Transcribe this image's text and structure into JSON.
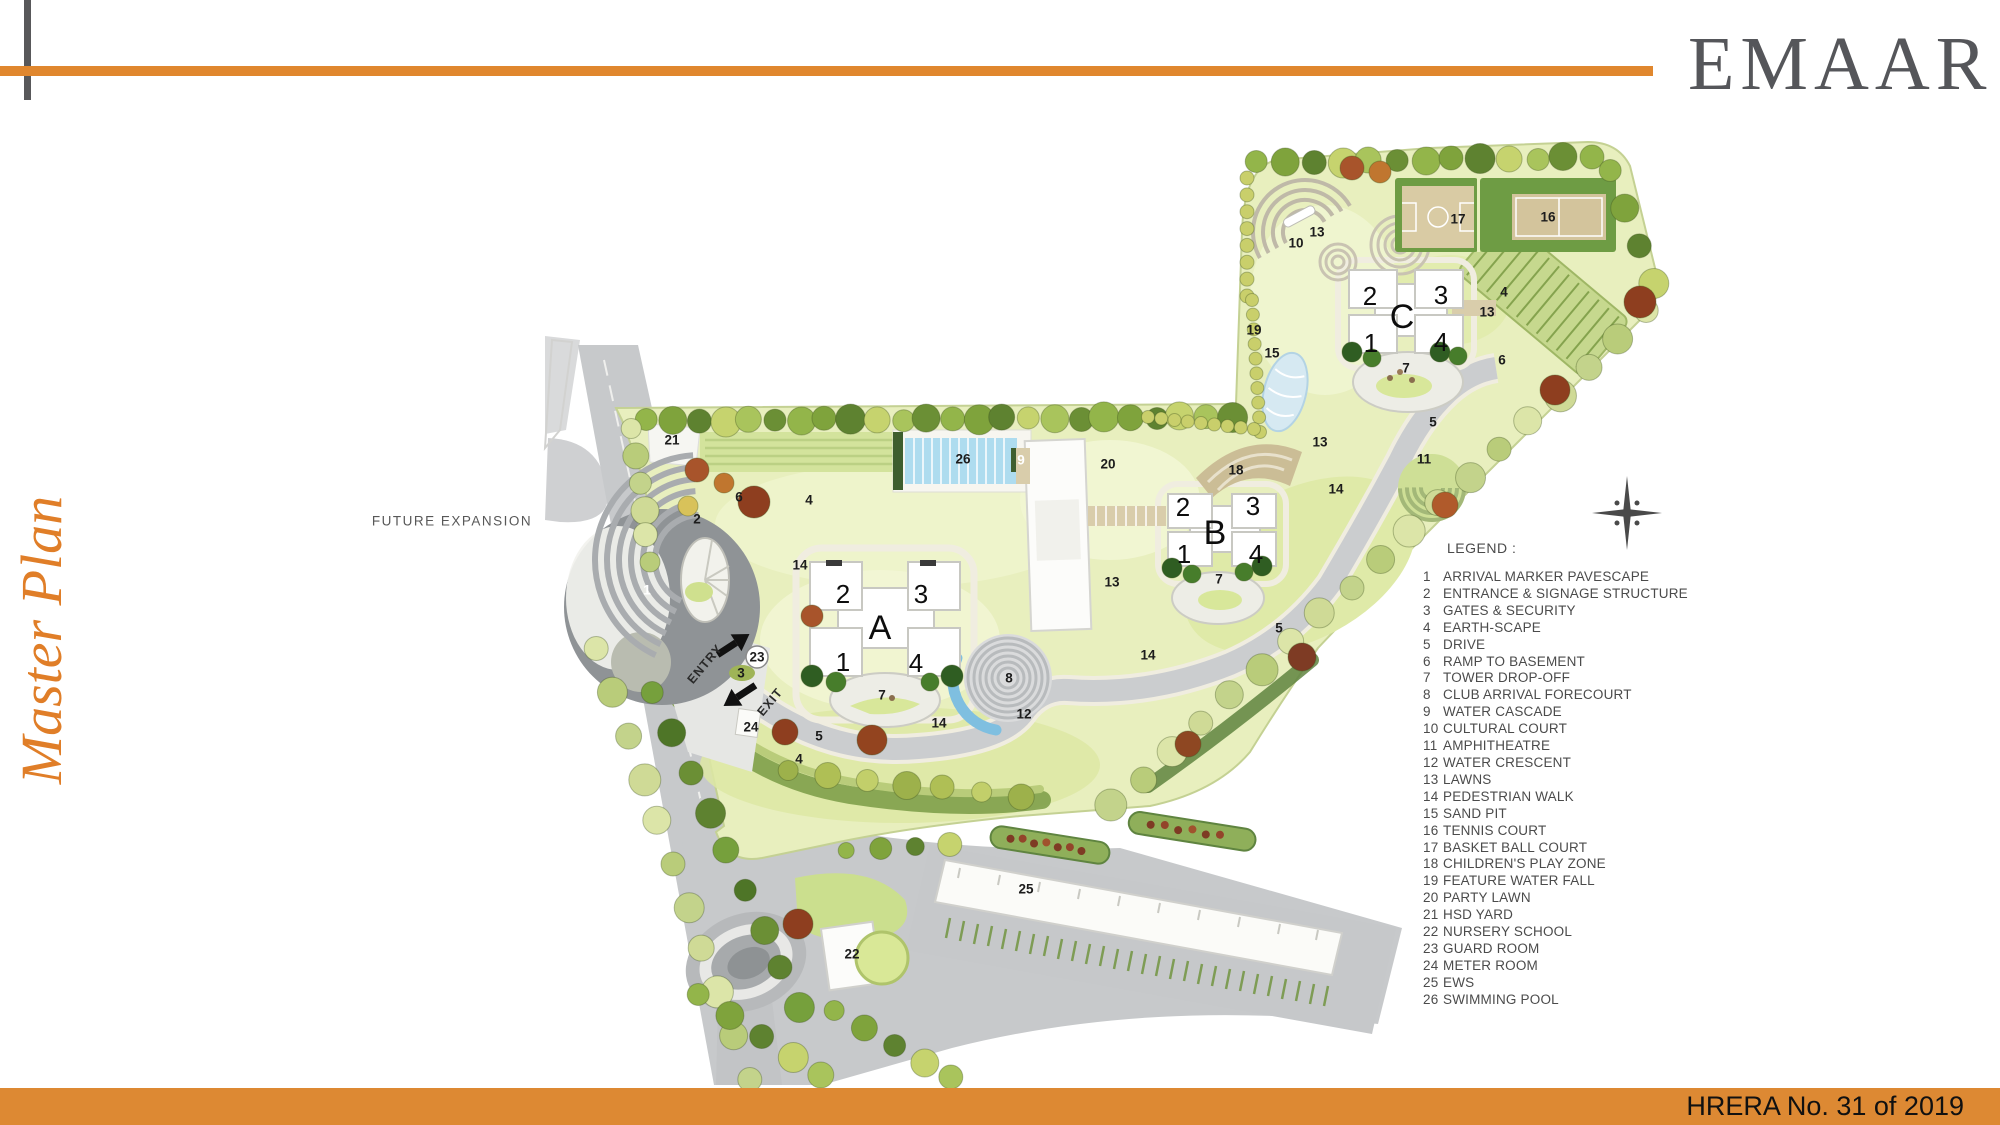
{
  "header": {
    "logo_text": "EMAAR",
    "accent_color": "#e0872e",
    "logo_color": "#55565a"
  },
  "page_title": {
    "text": "Master Plan",
    "color": "#e07e28"
  },
  "footer": {
    "text": "HRERA No. 31 of 2019",
    "bar_color": "#dd8933"
  },
  "map": {
    "future_expansion_label": "FUTURE EXPANSION",
    "entry_label": "ENTRY",
    "exit_label": "EXIT",
    "towers": [
      {
        "letter": "A",
        "x": 880,
        "y": 628,
        "corners": [
          {
            "t": "2",
            "x": 843,
            "y": 594
          },
          {
            "t": "3",
            "x": 921,
            "y": 594
          },
          {
            "t": "1",
            "x": 843,
            "y": 662
          },
          {
            "t": "4",
            "x": 916,
            "y": 663
          }
        ]
      },
      {
        "letter": "B",
        "x": 1215,
        "y": 533,
        "corners": [
          {
            "t": "2",
            "x": 1183,
            "y": 507
          },
          {
            "t": "3",
            "x": 1253,
            "y": 506
          },
          {
            "t": "1",
            "x": 1184,
            "y": 554
          },
          {
            "t": "4",
            "x": 1256,
            "y": 554
          }
        ]
      },
      {
        "letter": "C",
        "x": 1402,
        "y": 317,
        "corners": [
          {
            "t": "2",
            "x": 1370,
            "y": 296
          },
          {
            "t": "3",
            "x": 1441,
            "y": 295
          },
          {
            "t": "1",
            "x": 1371,
            "y": 343
          },
          {
            "t": "4",
            "x": 1441,
            "y": 342
          }
        ]
      }
    ],
    "number_labels": [
      {
        "t": "21",
        "x": 672,
        "y": 440
      },
      {
        "t": "6",
        "x": 739,
        "y": 497
      },
      {
        "t": "2",
        "x": 697,
        "y": 519
      },
      {
        "t": "4",
        "x": 809,
        "y": 500
      },
      {
        "t": "14",
        "x": 800,
        "y": 565
      },
      {
        "t": "1",
        "x": 647,
        "y": 590,
        "w": 1
      },
      {
        "t": "26",
        "x": 963,
        "y": 459
      },
      {
        "t": "9",
        "x": 1021,
        "y": 460,
        "w": 1
      },
      {
        "t": "20",
        "x": 1108,
        "y": 464
      },
      {
        "t": "18",
        "x": 1236,
        "y": 470
      },
      {
        "t": "13",
        "x": 1317,
        "y": 232
      },
      {
        "t": "13",
        "x": 1487,
        "y": 312
      },
      {
        "t": "13",
        "x": 1320,
        "y": 442
      },
      {
        "t": "13",
        "x": 1112,
        "y": 582
      },
      {
        "t": "10",
        "x": 1296,
        "y": 243
      },
      {
        "t": "19",
        "x": 1254,
        "y": 330
      },
      {
        "t": "15",
        "x": 1272,
        "y": 353
      },
      {
        "t": "16",
        "x": 1548,
        "y": 217
      },
      {
        "t": "17",
        "x": 1458,
        "y": 219
      },
      {
        "t": "4",
        "x": 1504,
        "y": 292
      },
      {
        "t": "6",
        "x": 1502,
        "y": 360
      },
      {
        "t": "7",
        "x": 1406,
        "y": 368
      },
      {
        "t": "5",
        "x": 1433,
        "y": 422
      },
      {
        "t": "11",
        "x": 1424,
        "y": 459
      },
      {
        "t": "14",
        "x": 1336,
        "y": 489
      },
      {
        "t": "5",
        "x": 1279,
        "y": 628
      },
      {
        "t": "14",
        "x": 1148,
        "y": 655
      },
      {
        "t": "7",
        "x": 1219,
        "y": 579
      },
      {
        "t": "7",
        "x": 882,
        "y": 695
      },
      {
        "t": "8",
        "x": 1009,
        "y": 678
      },
      {
        "t": "12",
        "x": 1024,
        "y": 714
      },
      {
        "t": "14",
        "x": 939,
        "y": 723
      },
      {
        "t": "23",
        "x": 757,
        "y": 657
      },
      {
        "t": "3",
        "x": 741,
        "y": 673
      },
      {
        "t": "24",
        "x": 751,
        "y": 727
      },
      {
        "t": "5",
        "x": 819,
        "y": 736
      },
      {
        "t": "4",
        "x": 799,
        "y": 759
      },
      {
        "t": "22",
        "x": 852,
        "y": 954
      },
      {
        "t": "25",
        "x": 1026,
        "y": 889
      }
    ]
  },
  "legend": {
    "title": "LEGEND :",
    "items": [
      {
        "n": "1",
        "label": "ARRIVAL MARKER PAVESCAPE"
      },
      {
        "n": "2",
        "label": "ENTRANCE & SIGNAGE STRUCTURE"
      },
      {
        "n": "3",
        "label": "GATES & SECURITY"
      },
      {
        "n": "4",
        "label": "EARTH-SCAPE"
      },
      {
        "n": "5",
        "label": "DRIVE"
      },
      {
        "n": "6",
        "label": "RAMP TO BASEMENT"
      },
      {
        "n": "7",
        "label": "TOWER DROP-OFF"
      },
      {
        "n": "8",
        "label": "CLUB ARRIVAL FORECOURT"
      },
      {
        "n": "9",
        "label": "WATER CASCADE"
      },
      {
        "n": "10",
        "label": "CULTURAL COURT"
      },
      {
        "n": "11",
        "label": "AMPHITHEATRE"
      },
      {
        "n": "12",
        "label": "WATER CRESCENT"
      },
      {
        "n": "13",
        "label": "LAWNS"
      },
      {
        "n": "14",
        "label": "PEDESTRIAN WALK"
      },
      {
        "n": "15",
        "label": "SAND PIT"
      },
      {
        "n": "16",
        "label": "TENNIS COURT"
      },
      {
        "n": "17",
        "label": "BASKET BALL COURT"
      },
      {
        "n": "18",
        "label": "CHILDREN'S PLAY ZONE"
      },
      {
        "n": "19",
        "label": "FEATURE WATER FALL"
      },
      {
        "n": "20",
        "label": "PARTY LAWN"
      },
      {
        "n": "21",
        "label": "HSD YARD"
      },
      {
        "n": "22",
        "label": "NURSERY SCHOOL"
      },
      {
        "n": "23",
        "label": "GUARD ROOM"
      },
      {
        "n": "24",
        "label": "METER ROOM"
      },
      {
        "n": "25",
        "label": "EWS"
      },
      {
        "n": "26",
        "label": "SWIMMING POOL"
      }
    ]
  }
}
